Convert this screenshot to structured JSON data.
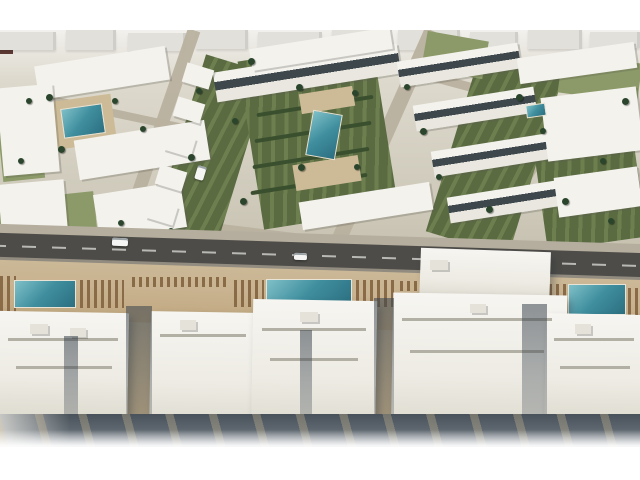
{
  "meta": {
    "description": "Aerial 3D architectural rendering of a white resort-style residential complex: villa blocks with green gardens and palm trees around courtyard pools, a main road with cars, and a beachfront row of large apartment buildings with lounger-lined pool decks."
  },
  "palette": {
    "frame": "#ffffff",
    "base_top": "#f2f1ed",
    "distant": "#e1e0db",
    "distant_dark": "#5f3a34",
    "street": "#b9b19f",
    "lawn_light": "#8b9a68",
    "lawn_dark": "#5a6b42",
    "lawn_dark2": "#6d7f4f",
    "hedge": "#394f2e",
    "sand": "#cdbb97",
    "bldg": "#f3f2ed",
    "band": "#3d474c",
    "pool_hi": "#7fc0c8",
    "pool_mid": "#3f8e9e",
    "pool_lo": "#2c6f81",
    "pool_rim": "#e8e3d5",
    "palm": "#2a452c",
    "palm_dark": "#1d311f",
    "walk": "#b5ae9e",
    "road": "#4d4c48",
    "roadline": "#dcdcd8",
    "curb": "#918b80",
    "deck": "#c9b390",
    "lounger": "#8a6b48",
    "tower_hi": "#f6f5f1",
    "tower_lo": "#d9d6ca",
    "roofline": "#b2afa4",
    "vent": "#e4e2d9",
    "band_top": "#49525a",
    "band_mid": "#5d666e",
    "band_low": "#8d959d"
  },
  "scene": {
    "names": {
      "distant": "distant-building",
      "street": "street",
      "lawn": "garden-lawn",
      "hedge": "hedge-row",
      "sand": "pool-sand-deck",
      "bldg": "apartment-building",
      "pool": "courtyard-pool",
      "palm": "palm-tree",
      "walk": "sidewalk",
      "road": "main-road",
      "curb": "road-curb",
      "car": "car",
      "deck": "promenade-deck",
      "lounge": "sun-lounger-row",
      "poolb": "resort-pool",
      "tower": "beachfront-building",
      "roof": "roof-line",
      "vent": "roof-structure",
      "gap": "building-shadow-gap"
    },
    "objects": {
      "distant": [
        {
          "x": 0,
          "y": 40,
          "w": 13,
          "h": 14,
          "v": "dark"
        },
        {
          "x": 0,
          "y": 32,
          "w": 56,
          "h": 18
        },
        {
          "x": 66,
          "y": 30,
          "w": 50,
          "h": 20
        },
        {
          "x": 128,
          "y": 33,
          "w": 58,
          "h": 18
        },
        {
          "x": 196,
          "y": 29,
          "w": 52,
          "h": 20
        },
        {
          "x": 258,
          "y": 32,
          "w": 64,
          "h": 18
        },
        {
          "x": 332,
          "y": 29,
          "w": 56,
          "h": 22
        },
        {
          "x": 398,
          "y": 30,
          "w": 62,
          "h": 20
        },
        {
          "x": 470,
          "y": 32,
          "w": 48,
          "h": 16
        },
        {
          "x": 528,
          "y": 29,
          "w": 54,
          "h": 20
        },
        {
          "x": 590,
          "y": 32,
          "w": 50,
          "h": 16
        }
      ],
      "street": [
        {
          "x": 150,
          "y": 24,
          "w": 13,
          "h": 231,
          "r": 19
        },
        {
          "x": 375,
          "y": 20,
          "w": 15,
          "h": 243,
          "r": 24
        },
        {
          "x": 534,
          "y": 42,
          "w": 12,
          "h": 225,
          "r": 32
        },
        {
          "x": -2,
          "y": 218,
          "w": 348,
          "h": 9,
          "r": 7
        },
        {
          "x": 404,
          "y": 97,
          "w": 240,
          "h": 9,
          "r": 15
        },
        {
          "x": 33,
          "y": 110,
          "w": 170,
          "h": 8,
          "r": 12
        }
      ],
      "lawn": [
        {
          "x": 178,
          "y": 60,
          "w": 66,
          "h": 182,
          "r": 17,
          "v": "dark"
        },
        {
          "x": 250,
          "y": 50,
          "w": 136,
          "h": 170,
          "r": -9,
          "v": "dark"
        },
        {
          "x": 452,
          "y": 56,
          "w": 86,
          "h": 192,
          "r": 17,
          "v": "dark"
        },
        {
          "x": 540,
          "y": 138,
          "w": 100,
          "h": 106,
          "r": -8,
          "v": "dark"
        },
        {
          "x": 0,
          "y": 196,
          "w": 96,
          "h": 50,
          "r": -6,
          "v": "light"
        },
        {
          "x": 100,
          "y": 194,
          "w": 72,
          "h": 50,
          "r": -8,
          "v": "light"
        },
        {
          "x": 0,
          "y": 118,
          "w": 42,
          "h": 62,
          "r": -6,
          "v": "light"
        },
        {
          "x": 424,
          "y": 36,
          "w": 62,
          "h": 38,
          "r": 10,
          "v": "light"
        },
        {
          "x": 560,
          "y": 58,
          "w": 80,
          "h": 40,
          "r": 8,
          "v": "light"
        }
      ],
      "hedge": [
        {
          "x": 258,
          "y": 78,
          "w": 118,
          "h": 4,
          "r": -9
        },
        {
          "x": 256,
          "y": 104,
          "w": 118,
          "h": 4,
          "r": -9
        },
        {
          "x": 254,
          "y": 130,
          "w": 118,
          "h": 4,
          "r": -9
        },
        {
          "x": 252,
          "y": 156,
          "w": 118,
          "h": 4,
          "r": -9
        },
        {
          "x": 250,
          "y": 182,
          "w": 118,
          "h": 4,
          "r": -9
        }
      ],
      "sand": [
        {
          "x": 50,
          "y": 98,
          "w": 64,
          "h": 48,
          "r": -8
        },
        {
          "x": 300,
          "y": 90,
          "w": 54,
          "h": 20,
          "r": -9
        },
        {
          "x": 294,
          "y": 160,
          "w": 66,
          "h": 26,
          "r": -9
        },
        {
          "x": 96,
          "y": 148,
          "w": 40,
          "h": 18,
          "r": -9
        }
      ],
      "bldg": [
        {
          "x": 36,
          "y": 56,
          "w": 132,
          "h": 34,
          "r": -9
        },
        {
          "x": 0,
          "y": 86,
          "w": 56,
          "h": 88,
          "r": -5
        },
        {
          "x": 76,
          "y": 130,
          "w": 132,
          "h": 40,
          "r": -9
        },
        {
          "x": 0,
          "y": 182,
          "w": 66,
          "h": 56,
          "r": -5
        },
        {
          "x": 96,
          "y": 188,
          "w": 88,
          "h": 46,
          "r": -9
        },
        {
          "x": 214,
          "y": 58,
          "w": 186,
          "h": 30,
          "r": -9,
          "v": "band"
        },
        {
          "x": 250,
          "y": 38,
          "w": 142,
          "h": 22,
          "r": -9
        },
        {
          "x": 300,
          "y": 192,
          "w": 132,
          "h": 28,
          "r": -9
        },
        {
          "x": 398,
          "y": 52,
          "w": 122,
          "h": 26,
          "r": -9,
          "v": "band"
        },
        {
          "x": 414,
          "y": 96,
          "w": 122,
          "h": 26,
          "r": -9,
          "v": "band"
        },
        {
          "x": 432,
          "y": 142,
          "w": 122,
          "h": 26,
          "r": -9,
          "v": "band"
        },
        {
          "x": 448,
          "y": 188,
          "w": 122,
          "h": 26,
          "r": -9,
          "v": "band"
        },
        {
          "x": 518,
          "y": 50,
          "w": 118,
          "h": 26,
          "r": -8
        },
        {
          "x": 544,
          "y": 92,
          "w": 96,
          "h": 64,
          "r": -7
        },
        {
          "x": 556,
          "y": 172,
          "w": 84,
          "h": 40,
          "r": -8
        },
        {
          "x": 184,
          "y": 66,
          "w": 28,
          "h": 20,
          "r": 17
        },
        {
          "x": 175,
          "y": 100,
          "w": 28,
          "h": 20,
          "r": 17
        },
        {
          "x": 166,
          "y": 134,
          "w": 28,
          "h": 20,
          "r": 17
        },
        {
          "x": 157,
          "y": 168,
          "w": 28,
          "h": 20,
          "r": 17
        },
        {
          "x": 148,
          "y": 202,
          "w": 28,
          "h": 20,
          "r": 17
        }
      ],
      "pool": [
        {
          "x": 62,
          "y": 106,
          "w": 42,
          "h": 30,
          "r": -8
        },
        {
          "x": 309,
          "y": 112,
          "w": 30,
          "h": 46,
          "r": 10
        },
        {
          "x": 526,
          "y": 104,
          "w": 20,
          "h": 13,
          "r": -8
        }
      ],
      "palm": [
        {
          "x": 46,
          "y": 94,
          "w": 7,
          "h": 7
        },
        {
          "x": 112,
          "y": 98,
          "w": 6,
          "h": 6
        },
        {
          "x": 58,
          "y": 146,
          "w": 7,
          "h": 7
        },
        {
          "x": 140,
          "y": 126,
          "w": 6,
          "h": 6
        },
        {
          "x": 196,
          "y": 88,
          "w": 6,
          "h": 6
        },
        {
          "x": 188,
          "y": 154,
          "w": 7,
          "h": 7
        },
        {
          "x": 232,
          "y": 118,
          "w": 6,
          "h": 6
        },
        {
          "x": 248,
          "y": 58,
          "w": 7,
          "h": 7
        },
        {
          "x": 296,
          "y": 84,
          "w": 7,
          "h": 7
        },
        {
          "x": 352,
          "y": 90,
          "w": 6,
          "h": 6
        },
        {
          "x": 298,
          "y": 164,
          "w": 7,
          "h": 7
        },
        {
          "x": 354,
          "y": 164,
          "w": 6,
          "h": 6
        },
        {
          "x": 240,
          "y": 198,
          "w": 7,
          "h": 7
        },
        {
          "x": 404,
          "y": 84,
          "w": 6,
          "h": 6
        },
        {
          "x": 420,
          "y": 128,
          "w": 7,
          "h": 7
        },
        {
          "x": 436,
          "y": 174,
          "w": 6,
          "h": 6
        },
        {
          "x": 516,
          "y": 94,
          "w": 7,
          "h": 7
        },
        {
          "x": 540,
          "y": 128,
          "w": 6,
          "h": 6
        },
        {
          "x": 562,
          "y": 198,
          "w": 7,
          "h": 7
        },
        {
          "x": 600,
          "y": 158,
          "w": 6,
          "h": 6
        },
        {
          "x": 622,
          "y": 98,
          "w": 7,
          "h": 7
        },
        {
          "x": 118,
          "y": 220,
          "w": 6,
          "h": 6
        },
        {
          "x": 76,
          "y": 234,
          "w": 6,
          "h": 6
        },
        {
          "x": 168,
          "y": 228,
          "w": 6,
          "h": 6
        },
        {
          "x": 486,
          "y": 206,
          "w": 7,
          "h": 7
        },
        {
          "x": 608,
          "y": 218,
          "w": 6,
          "h": 6
        },
        {
          "x": 26,
          "y": 98,
          "w": 6,
          "h": 6
        },
        {
          "x": 18,
          "y": 158,
          "w": 6,
          "h": 6
        },
        {
          "x": 54,
          "y": 234,
          "w": 6,
          "h": 6
        },
        {
          "x": 150,
          "y": 238,
          "w": 6,
          "h": 6
        },
        {
          "x": 250,
          "y": 241,
          "w": 6,
          "h": 6
        },
        {
          "x": 352,
          "y": 244,
          "w": 6,
          "h": 6
        },
        {
          "x": 560,
          "y": 250,
          "w": 6,
          "h": 6
        },
        {
          "x": 620,
          "y": 252,
          "w": 6,
          "h": 6
        }
      ],
      "walk": [
        {
          "x": -8,
          "y": 234,
          "w": 660,
          "h": 11,
          "r": 1.8
        }
      ],
      "road": [
        {
          "x": -8,
          "y": 243,
          "w": 660,
          "h": 26,
          "r": 1.8
        }
      ],
      "curb": [
        {
          "x": -8,
          "y": 267,
          "w": 660,
          "h": 5,
          "r": 1.8
        }
      ],
      "car": [
        {
          "x": 112,
          "y": 238,
          "w": 16,
          "h": 8,
          "r": 2,
          "v": "white"
        },
        {
          "x": 294,
          "y": 253,
          "w": 13,
          "h": 7,
          "r": 2,
          "v": "white"
        },
        {
          "x": 196,
          "y": 166,
          "w": 9,
          "h": 14,
          "r": 17,
          "v": "white"
        },
        {
          "x": 470,
          "y": 261,
          "w": 12,
          "h": 6,
          "r": 2,
          "v": "gray"
        }
      ],
      "deck": [
        {
          "x": -8,
          "y": 270,
          "w": 660,
          "h": 58,
          "r": 1.8
        }
      ],
      "lounge": [
        {
          "x": 0,
          "y": 276,
          "w": 16,
          "h": 42
        },
        {
          "x": 80,
          "y": 280,
          "w": 44,
          "h": 28
        },
        {
          "x": 132,
          "y": 277,
          "w": 96,
          "h": 10
        },
        {
          "x": 234,
          "y": 280,
          "w": 30,
          "h": 27
        },
        {
          "x": 356,
          "y": 280,
          "w": 40,
          "h": 27
        },
        {
          "x": 400,
          "y": 281,
          "w": 56,
          "h": 10
        },
        {
          "x": 528,
          "y": 284,
          "w": 38,
          "h": 28
        },
        {
          "x": 628,
          "y": 288,
          "w": 12,
          "h": 28
        }
      ],
      "poolb": [
        {
          "x": 14,
          "y": 280,
          "w": 62,
          "h": 28
        },
        {
          "x": 266,
          "y": 279,
          "w": 86,
          "h": 27
        },
        {
          "x": 568,
          "y": 284,
          "w": 58,
          "h": 31
        }
      ],
      "tower": [
        {
          "x": 420,
          "y": 250,
          "w": 130,
          "h": 56,
          "r": 2
        },
        {
          "x": -4,
          "y": 312,
          "w": 132,
          "h": 120,
          "r": 1
        },
        {
          "x": 150,
          "y": 312,
          "w": 104,
          "h": 130,
          "r": 1
        },
        {
          "x": 252,
          "y": 300,
          "w": 124,
          "h": 144,
          "r": 1
        },
        {
          "x": 392,
          "y": 294,
          "w": 174,
          "h": 150,
          "r": 1
        },
        {
          "x": 545,
          "y": 314,
          "w": 99,
          "h": 122,
          "r": 1
        }
      ],
      "roof": [
        {
          "x": 8,
          "y": 338,
          "w": 110,
          "h": 3
        },
        {
          "x": 16,
          "y": 366,
          "w": 96,
          "h": 3
        },
        {
          "x": 160,
          "y": 334,
          "w": 86,
          "h": 3
        },
        {
          "x": 262,
          "y": 328,
          "w": 104,
          "h": 3
        },
        {
          "x": 270,
          "y": 358,
          "w": 88,
          "h": 3
        },
        {
          "x": 402,
          "y": 318,
          "w": 150,
          "h": 3
        },
        {
          "x": 410,
          "y": 350,
          "w": 134,
          "h": 3
        },
        {
          "x": 554,
          "y": 338,
          "w": 80,
          "h": 3
        },
        {
          "x": 560,
          "y": 366,
          "w": 70,
          "h": 3
        }
      ],
      "vent": [
        {
          "x": 30,
          "y": 324,
          "w": 18,
          "h": 10
        },
        {
          "x": 70,
          "y": 328,
          "w": 16,
          "h": 9
        },
        {
          "x": 180,
          "y": 320,
          "w": 16,
          "h": 10
        },
        {
          "x": 300,
          "y": 312,
          "w": 18,
          "h": 10
        },
        {
          "x": 430,
          "y": 260,
          "w": 18,
          "h": 10
        },
        {
          "x": 470,
          "y": 304,
          "w": 16,
          "h": 9
        },
        {
          "x": 575,
          "y": 324,
          "w": 16,
          "h": 10
        }
      ],
      "gap": [
        {
          "x": 126,
          "y": 306,
          "w": 26,
          "h": 142
        },
        {
          "x": 374,
          "y": 298,
          "w": 20,
          "h": 150
        },
        {
          "x": 522,
          "y": 304,
          "w": 25,
          "h": 144
        },
        {
          "x": 64,
          "y": 336,
          "w": 14,
          "h": 112
        },
        {
          "x": 300,
          "y": 330,
          "w": 12,
          "h": 118
        }
      ]
    }
  }
}
